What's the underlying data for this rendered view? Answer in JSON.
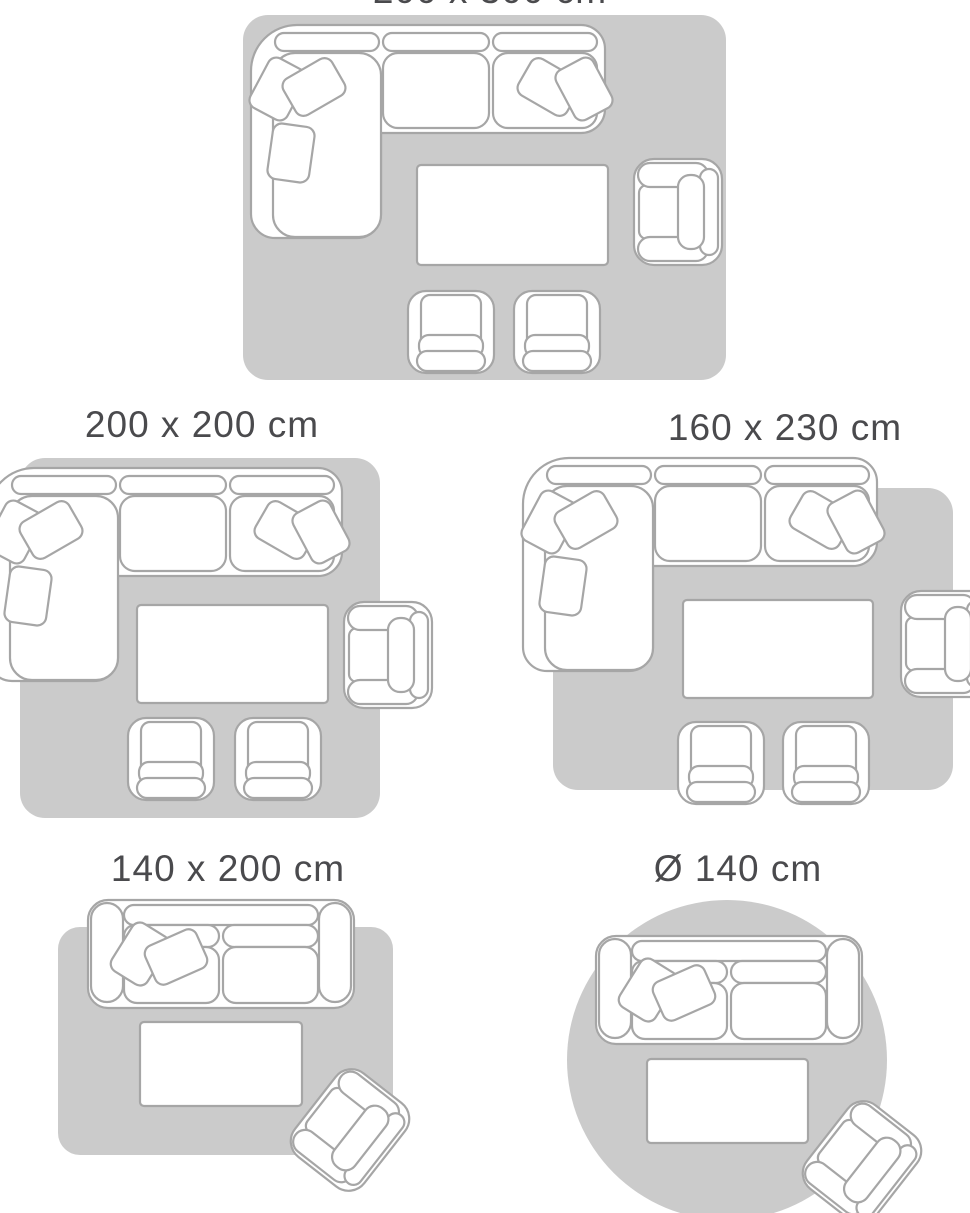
{
  "colors": {
    "background": "#ffffff",
    "rug": "#cbcbcb",
    "outline": "#a6a6a6",
    "label": "#4a4a4d"
  },
  "guide": {
    "type": "rug-size-guide",
    "scenes": [
      {
        "label": "200 x 300 cm",
        "rug_shape": "rectangle",
        "furniture": [
          "corner sofa",
          "coffee table",
          "armchair",
          "club chair",
          "club chair"
        ]
      },
      {
        "label": "200 x 200 cm",
        "rug_shape": "rectangle",
        "furniture": [
          "corner sofa",
          "coffee table",
          "armchair",
          "club chair",
          "club chair"
        ]
      },
      {
        "label": "160 x 230 cm",
        "rug_shape": "rectangle",
        "furniture": [
          "corner sofa",
          "coffee table",
          "armchair",
          "club chair",
          "club chair"
        ]
      },
      {
        "label": "140 x 200 cm",
        "rug_shape": "rectangle",
        "furniture": [
          "two-seat sofa",
          "coffee table",
          "armchair"
        ]
      },
      {
        "label": "Ø 140 cm",
        "rug_shape": "circle",
        "furniture": [
          "two-seat sofa",
          "coffee table",
          "armchair"
        ]
      }
    ]
  }
}
